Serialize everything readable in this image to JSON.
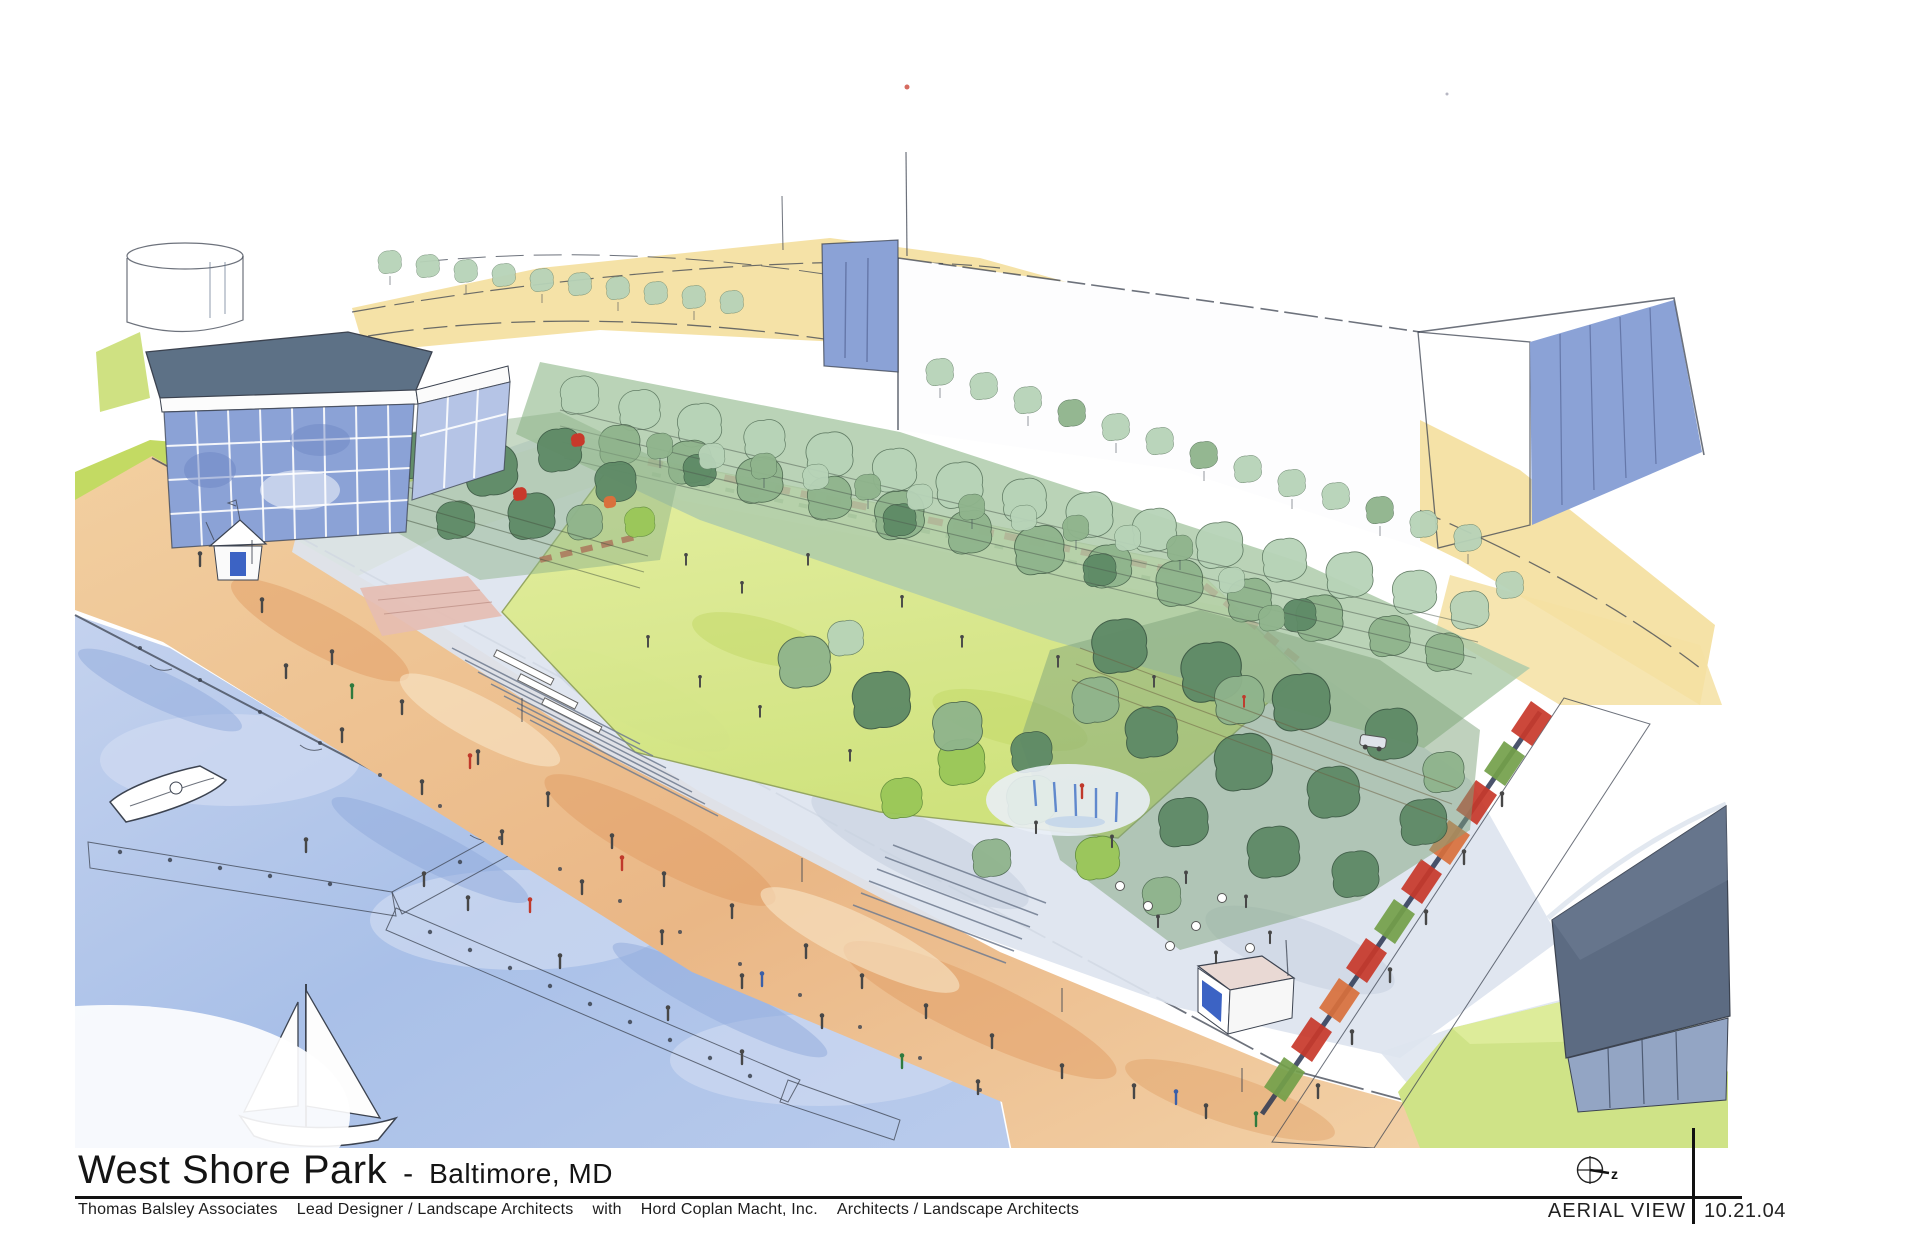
{
  "sheet": {
    "title": "West Shore Park",
    "title_separator": "-",
    "location": "Baltimore, MD",
    "credit_firm_primary": "Thomas Balsley Associates",
    "credit_role_primary": "Lead Designer / Landscape Architects",
    "credit_conjunction": "with",
    "credit_firm_secondary": "Hord Coplan Macht, Inc.",
    "credit_role_secondary": "Architects / Landscape Architects",
    "view_label": "AERIAL VIEW",
    "date": "10.21.04",
    "north_marker_label": "z"
  },
  "palette": {
    "paper": "#ffffff",
    "ink": "#3c4350",
    "title_ink": "#141414",
    "water": "#a9c0e8",
    "water_light": "#cfdaf1",
    "promenade": "#eab786",
    "promenade_light": "#f6d9b2",
    "pier": "#efe0b4",
    "lawn": "#d7e783",
    "lawn_light": "#e8f3ad",
    "grass_side": "#c3da63",
    "street": "#f4e0a2",
    "tree_light": "#b7d3b8",
    "tree_mid": "#8fb48c",
    "tree_dark": "#5e8a66",
    "tree_lime": "#9ac758",
    "plaza": "#dde4ef",
    "plaza_deep": "#c7d0e0",
    "glass": "#8ba2d6",
    "glass_light": "#b5c4e6",
    "roof_dark": "#5d7186",
    "building_dark": "#5c6b82",
    "building_dark_glass": "#93a5c4",
    "flower_red": "#c8392b",
    "flower_orange": "#d9703c",
    "flower_green": "#74a04a",
    "terrace_pink": "#e6bdb1"
  }
}
